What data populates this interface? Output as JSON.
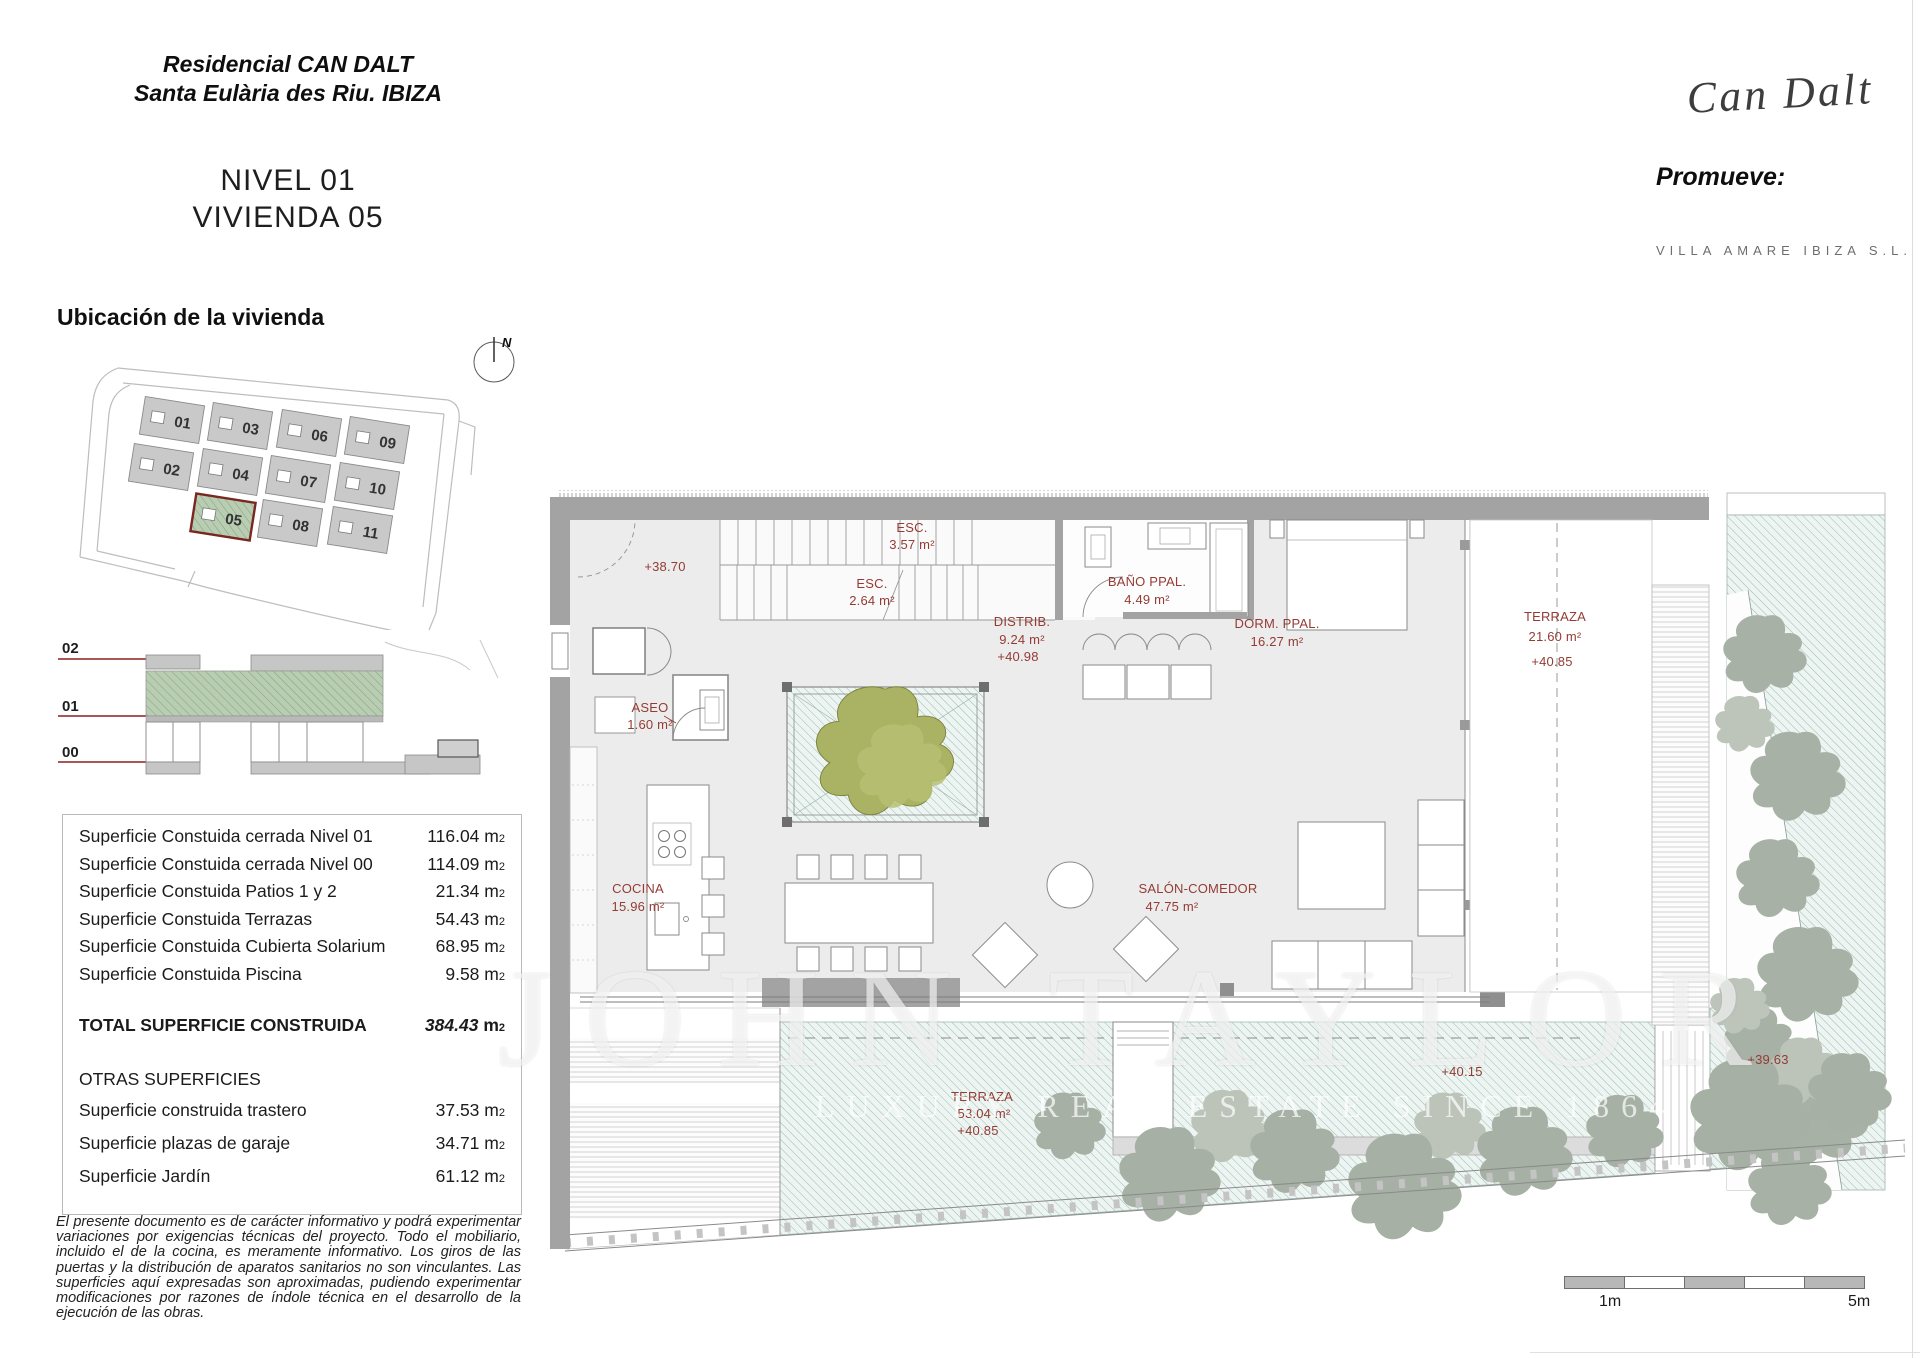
{
  "header": {
    "project_title_line1": "Residencial CAN DALT",
    "project_title_line2": "Santa Eulària des Riu. IBIZA",
    "level_line1": "NIVEL 01",
    "level_line2": "VIVIENDA 05",
    "logo_text": "Can Dalt",
    "promoter_label": "Promueve:",
    "promoter_name": "VILLA AMARE IBIZA S.L."
  },
  "location": {
    "heading": "Ubicación de la vivienda",
    "compass": "N",
    "units": [
      "01",
      "02",
      "03",
      "04",
      "05",
      "06",
      "07",
      "08",
      "09",
      "10",
      "11"
    ],
    "highlighted_unit": "05"
  },
  "section": {
    "levels": [
      "02",
      "01",
      "00"
    ]
  },
  "areas_table": {
    "unit": "m",
    "unit_sub": "2",
    "rows": [
      {
        "label": "Superficie Constuida cerrada Nivel 01",
        "value": "116.04"
      },
      {
        "label": "Superficie Constuida cerrada Nivel 00",
        "value": "114.09"
      },
      {
        "label": "Superficie Constuida Patios 1 y 2",
        "value": "21.34"
      },
      {
        "label": "Superficie Constuida Terrazas",
        "value": "54.43"
      },
      {
        "label": "Superficie Constuida Cubierta Solarium",
        "value": "68.95"
      },
      {
        "label": "Superficie Constuida Piscina",
        "value": "9.58"
      }
    ],
    "total": {
      "label": "TOTAL SUPERFICIE CONSTRUIDA",
      "value": "384.43"
    },
    "other_heading": "OTRAS SUPERFICIES",
    "other_rows": [
      {
        "label": "Superficie construida trastero",
        "value": "37.53"
      },
      {
        "label": "Superficie plazas de garaje",
        "value": "34.71"
      },
      {
        "label": "Superficie Jardín",
        "value": "61.12"
      }
    ]
  },
  "disclaimer": "El presente documento es de carácter informativo y podrá experimentar variaciones por exigencias técnicas del proyecto. Todo el mobiliario, incluido el de la cocina, es meramente informativo. Los giros de las puertas y la distribución de aparatos sanitarios no son vinculantes. Las superficies aquí expresadas son aproximadas, pudiendo experimentar modificaciones por razones de índole técnica en el desarrollo de la ejecución de las obras.",
  "plan": {
    "rooms": [
      {
        "name": "ESC.",
        "area": "3.57 m²"
      },
      {
        "name": "ESC.",
        "area": "2.64 m²"
      },
      {
        "name": "DISTRIB.",
        "area": "9.24 m²",
        "level": "+40.98"
      },
      {
        "name": "BAÑO PPAL.",
        "area": "4.49 m²"
      },
      {
        "name": "DORM. PPAL.",
        "area": "16.27 m²"
      },
      {
        "name": "TERRAZA",
        "area": "21.60 m²",
        "level": "+40.85"
      },
      {
        "name": "ASEO",
        "area": "1.60 m²"
      },
      {
        "name": "COCINA",
        "area": "15.96 m²"
      },
      {
        "name": "SALÓN-COMEDOR",
        "area": "47.75 m²"
      },
      {
        "name": "TERRAZA",
        "area": "53.04 m²",
        "level": "+40.85"
      }
    ],
    "spot_levels": [
      "+38.70",
      "+40.15",
      "+39.63"
    ]
  },
  "watermark": {
    "line1": "JOHN TAYLOR",
    "line2": "LUXURY REAL ESTATE SINCE 1864"
  },
  "scale_bar": {
    "start_label": "1m",
    "end_label": "5m"
  },
  "colors": {
    "accent_label": "#943b34",
    "level_line": "#8b1f1f",
    "highlight_green": "#a9c4a4",
    "teal_hatch": "#93bfb3",
    "wall_gray": "#a3a3a3"
  }
}
